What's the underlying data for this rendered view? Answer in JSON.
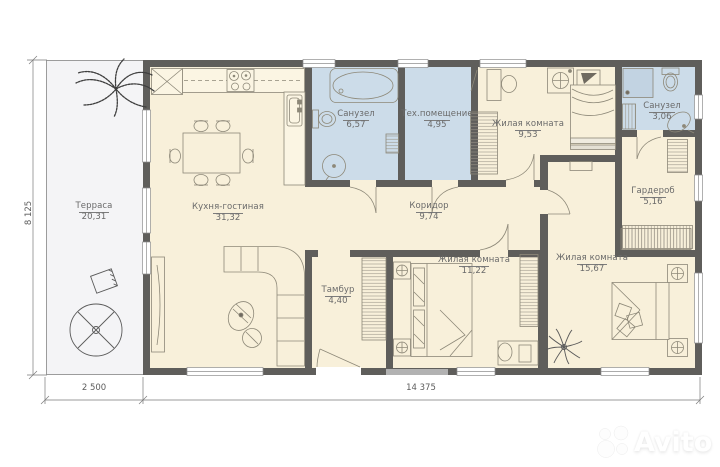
{
  "plan": {
    "rooms": [
      {
        "name": "Терраса",
        "area": "20,31"
      },
      {
        "name": "Кухня-гостиная",
        "area": "31,32"
      },
      {
        "name": "Санузел",
        "area": "6,57"
      },
      {
        "name": "Тех.помещение",
        "area": "4,95"
      },
      {
        "name": "Жилая комната",
        "area": "9,53"
      },
      {
        "name": "Санузел",
        "area": "3,06"
      },
      {
        "name": "Гардероб",
        "area": "5,16"
      },
      {
        "name": "Коридор",
        "area": "9,74"
      },
      {
        "name": "Тамбур",
        "area": "4,40"
      },
      {
        "name": "Жилая комната",
        "area": "11,22"
      },
      {
        "name": "Жилая комната",
        "area": "15,67"
      }
    ],
    "dimensions": {
      "height": "8 125",
      "terrace_width": "2 500",
      "house_width": "14 375"
    }
  },
  "watermark": {
    "text": "Avito"
  },
  "colors": {
    "wall": "#5f5e5b",
    "room": "#f8f0da",
    "wet_room": "#ccdce9",
    "terrace": "#f4f4f6"
  }
}
